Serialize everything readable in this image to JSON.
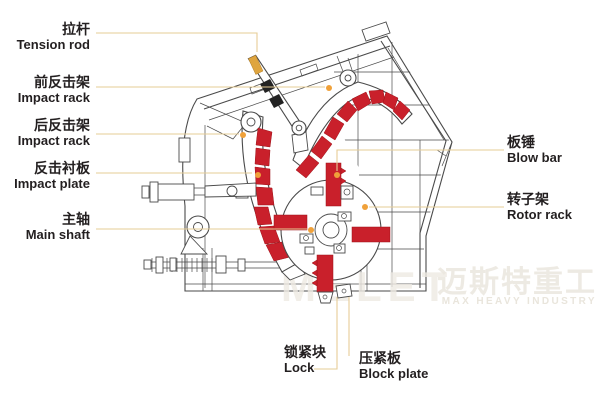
{
  "page": {
    "background": "#ffffff",
    "type": "impact-crusher-structure-diagram"
  },
  "colors": {
    "part_red": "#c9202b",
    "part_red_edge": "#9e1118",
    "line_dark": "#4a4a4a",
    "leader_tan": "#e6cc96",
    "dot_orange": "#f0a13a",
    "label_text": "#231f20",
    "wm1": "#eeeae3",
    "wm2": "#ece8e0",
    "wm3": "#e9e5dc"
  },
  "labels": {
    "tension_rod": {
      "zh": "拉杆",
      "en": "Tension rod"
    },
    "front_impact_rack": {
      "zh": "前反击架",
      "en": "Impact rack"
    },
    "rear_impact_rack": {
      "zh": "后反击架",
      "en": "Impact rack"
    },
    "impact_plate": {
      "zh": "反击衬板",
      "en": "Impact plate"
    },
    "main_shaft": {
      "zh": "主轴",
      "en": "Main shaft"
    },
    "blow_bar": {
      "zh": "板锤",
      "en": "Blow bar"
    },
    "rotor_rack": {
      "zh": "转子架",
      "en": "Rotor rack"
    },
    "lock": {
      "zh": "锁紧块",
      "en": "Lock"
    },
    "block_plate": {
      "zh": "压紧板",
      "en": "Block plate"
    }
  },
  "watermark": {
    "logo": "MELET",
    "zh": "迈斯特重工",
    "en": "MAX HEAVY INDUSTRY"
  }
}
